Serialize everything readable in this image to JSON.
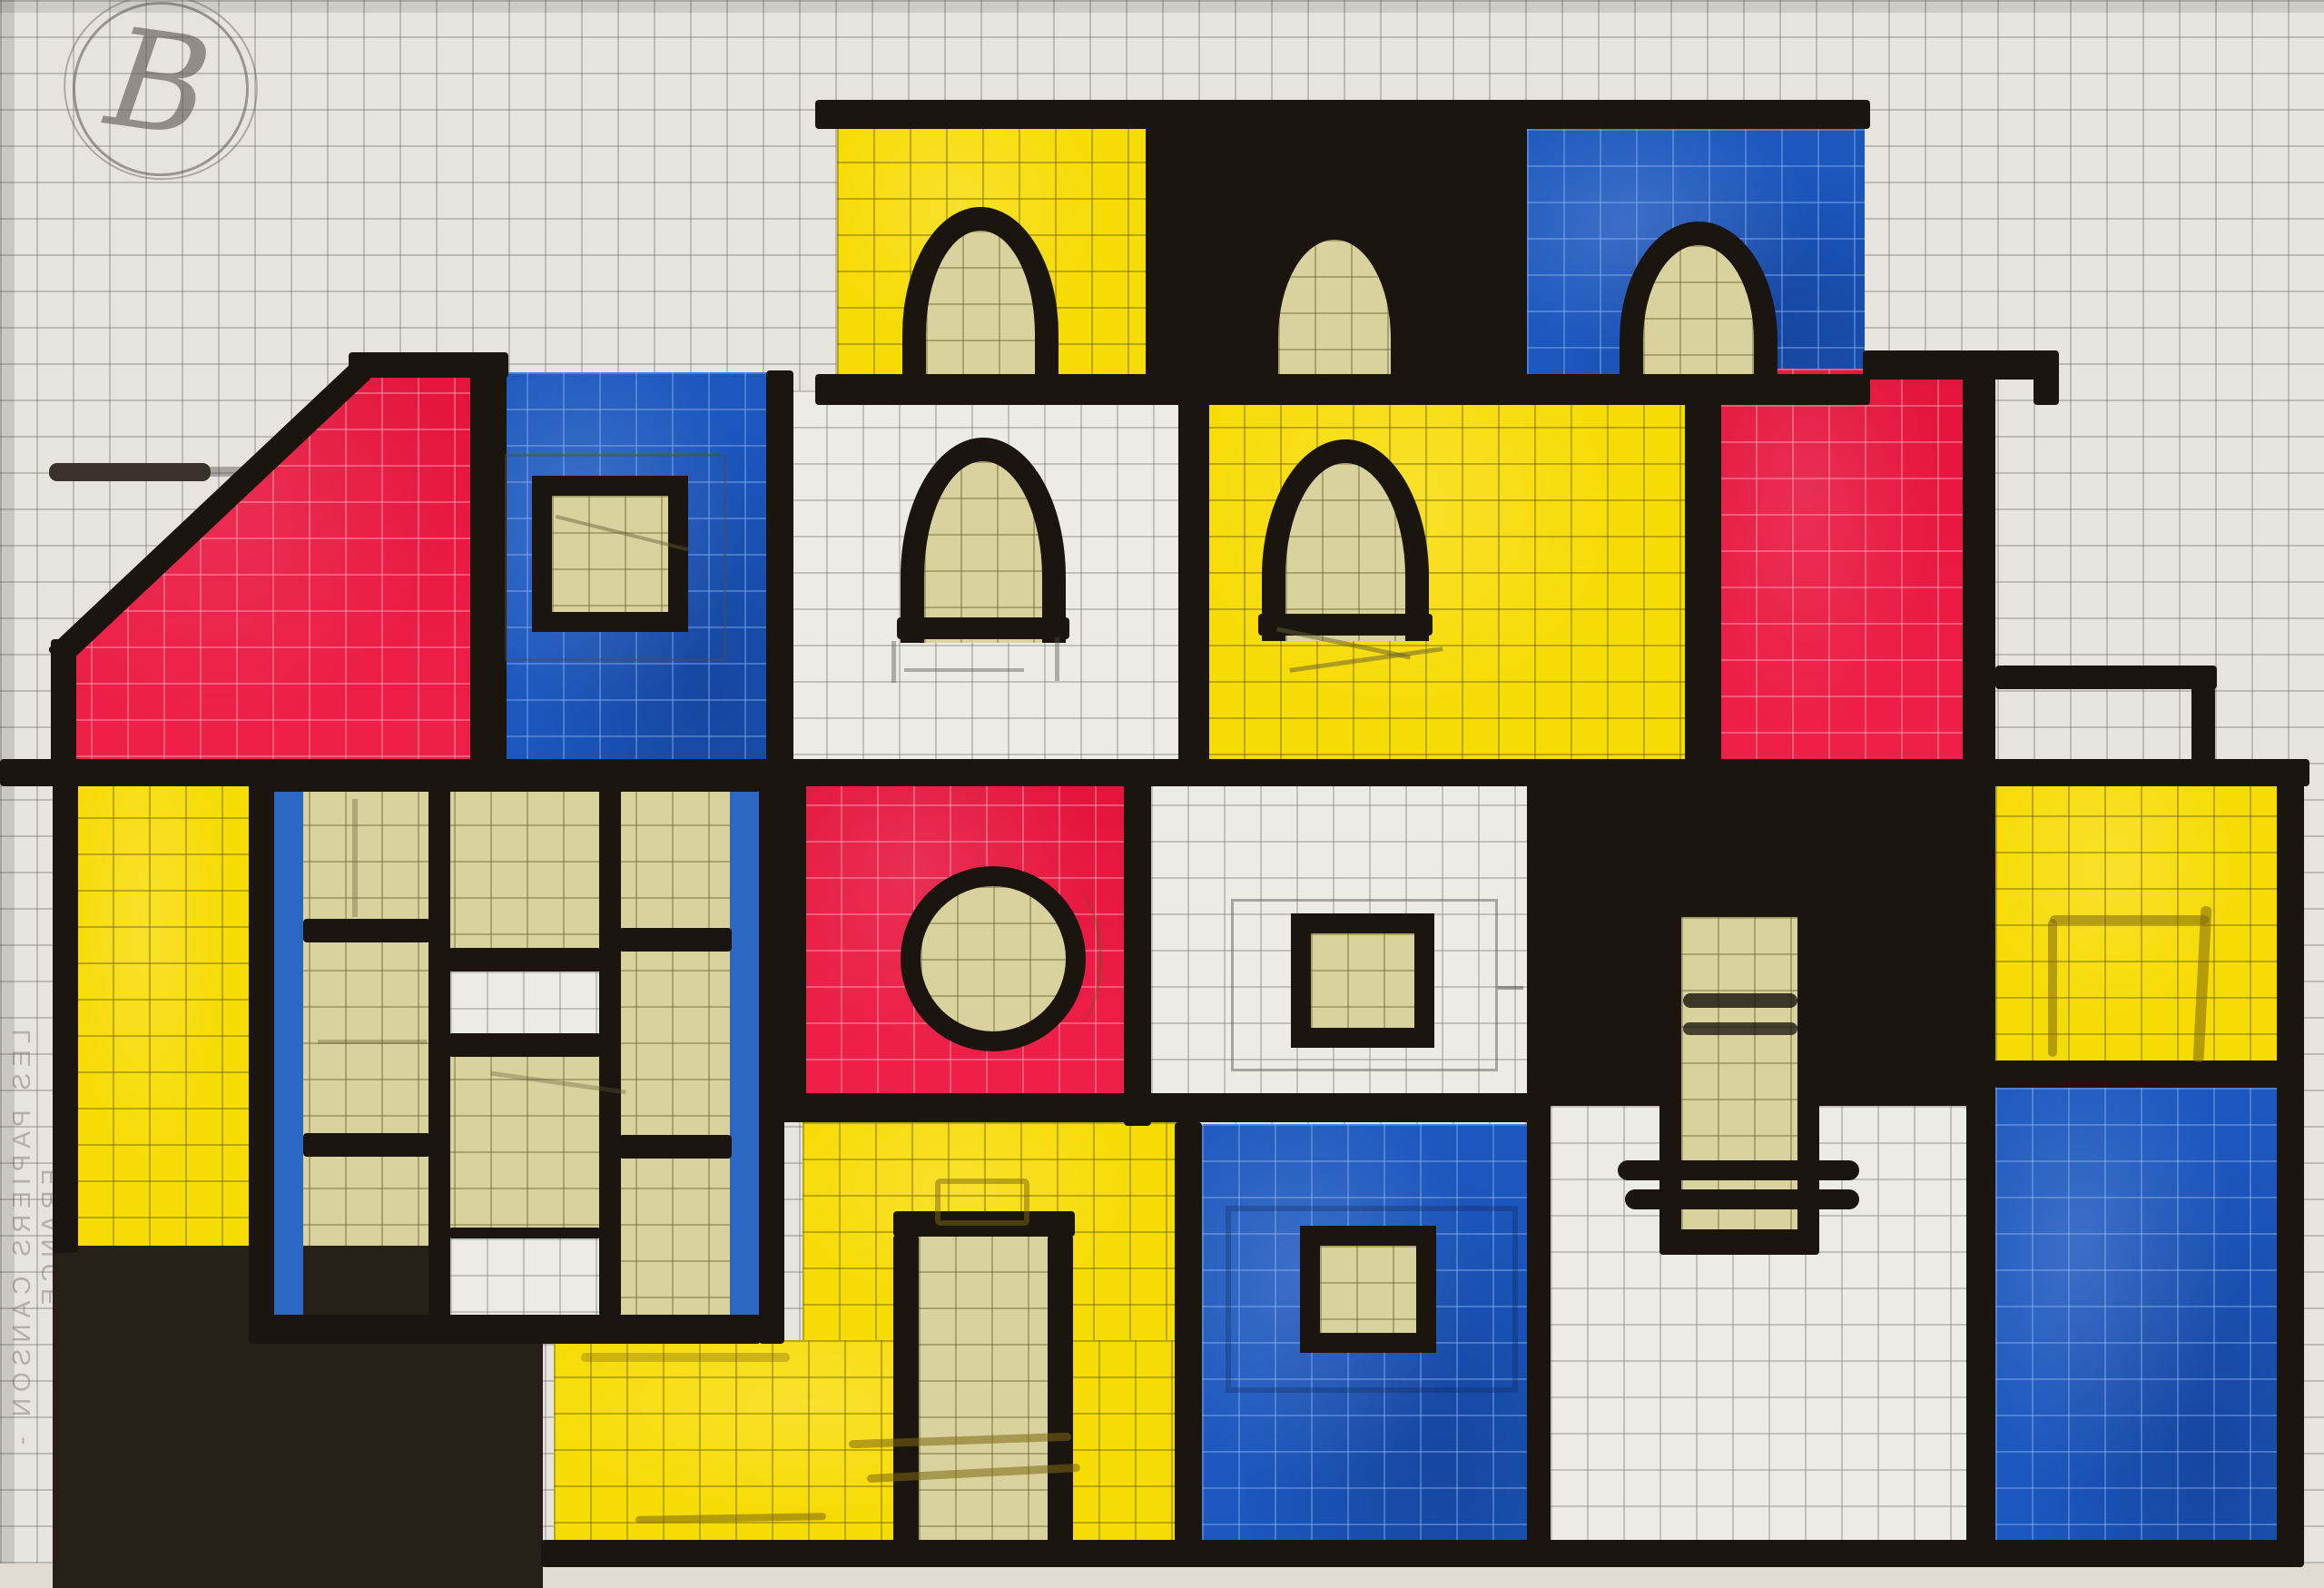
{
  "artwork": {
    "type": "marker-and-watercolor drawing on graph paper",
    "subject": "Mondrian-style house facade built from red, blue, yellow, black and white blocks",
    "signature": "B",
    "watermark": "LES PAPIERS CANSON - FRANCE",
    "palette": {
      "red": "#ee1540",
      "blue": "#1c57be",
      "yellow": "#f7db04",
      "khaki": "#d9d29e",
      "ink": "#1b1510",
      "ink2": "#262019",
      "paper": "#e7e3dd",
      "pencil": "#8a857e"
    },
    "blocks": [
      {
        "name": "attic-yellow",
        "color": "yellow",
        "feature": "arched window"
      },
      {
        "name": "attic-black",
        "color": "ink",
        "feature": "arched window"
      },
      {
        "name": "attic-blue",
        "color": "blue",
        "feature": "arched window"
      },
      {
        "name": "upper-red-pentagon",
        "color": "red",
        "feature": "slanted roof corner"
      },
      {
        "name": "upper-blue",
        "color": "blue",
        "feature": "square window"
      },
      {
        "name": "upper-white",
        "color": "paper",
        "feature": "arched window"
      },
      {
        "name": "upper-yellow",
        "color": "yellow",
        "feature": "arched window"
      },
      {
        "name": "upper-red-right",
        "color": "red"
      },
      {
        "name": "left-yellow-column",
        "color": "yellow"
      },
      {
        "name": "mullioned-window-grid",
        "color": "khaki",
        "feature": "blue side strips, black mullions, two white panes"
      },
      {
        "name": "red-circle-block",
        "color": "red",
        "feature": "round porthole window"
      },
      {
        "name": "white-square-window-block",
        "color": "paper",
        "feature": "square window with pencil sketch"
      },
      {
        "name": "right-black-block",
        "color": "ink",
        "feature": "tall shuttered opening"
      },
      {
        "name": "right-yellow-block",
        "color": "yellow",
        "feature": "pencil sketch rectangle"
      },
      {
        "name": "yellow-door-block",
        "color": "yellow",
        "feature": "tall door with pencil handle and steps"
      },
      {
        "name": "middle-blue-block",
        "color": "blue",
        "feature": "square window"
      },
      {
        "name": "white-ladder-block",
        "color": "paper",
        "feature": "ladder rungs"
      },
      {
        "name": "right-blue-block",
        "color": "blue"
      },
      {
        "name": "bottom-left-black-block",
        "color": "ink2"
      },
      {
        "name": "balcony-railing",
        "color": "ink"
      }
    ]
  }
}
